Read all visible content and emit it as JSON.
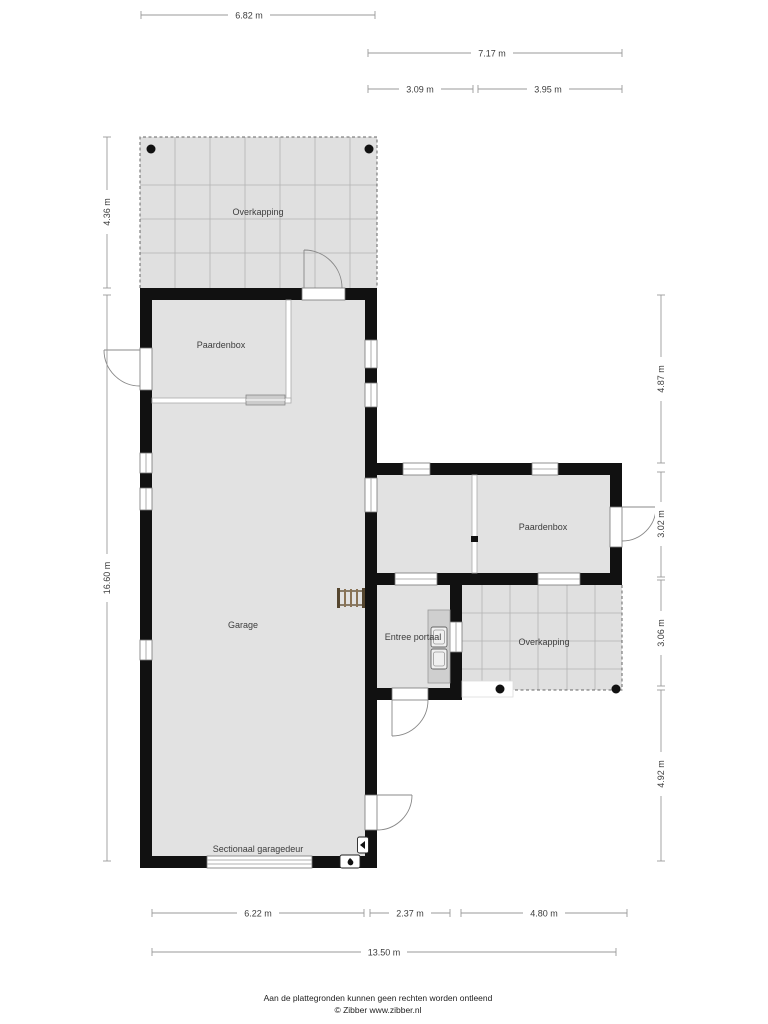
{
  "plan": {
    "rooms": {
      "overkapping_top": "Overkapping",
      "paardenbox_left": "Paardenbox",
      "garage": "Garage",
      "paardenbox_right": "Paardenbox",
      "entree_portaal": "Entree portaal",
      "overkapping_right": "Overkapping",
      "garage_door_label": "Sectionaal garagedeur"
    },
    "dimensions": {
      "top_main": "6.82 m",
      "top_wing_total": "7.17 m",
      "top_wing_left": "3.09 m",
      "top_wing_right": "3.95 m",
      "left_overkapping": "4.36 m",
      "left_total": "16.60 m",
      "right_upper_gap": "4.87 m",
      "right_wing": "3.02 m",
      "right_overkapping": "3.06 m",
      "right_lower": "4.92 m",
      "bottom_garage": "6.22 m",
      "bottom_entree": "2.37 m",
      "bottom_overkapping": "4.80 m",
      "bottom_total": "13.50 m"
    },
    "colors": {
      "wall": "#111111",
      "room_fill": "#e2e2e2",
      "canopy_fill": "#e0e0e0",
      "grid_line": "#b3b3b3",
      "dimension_line": "#9a9a9a",
      "ladder_wood": "#7d6a4f"
    }
  },
  "footer": {
    "disclaimer": "Aan de plattegronden kunnen geen rechten worden ontleend",
    "credit": "© Zibber www.zibber.nl"
  }
}
